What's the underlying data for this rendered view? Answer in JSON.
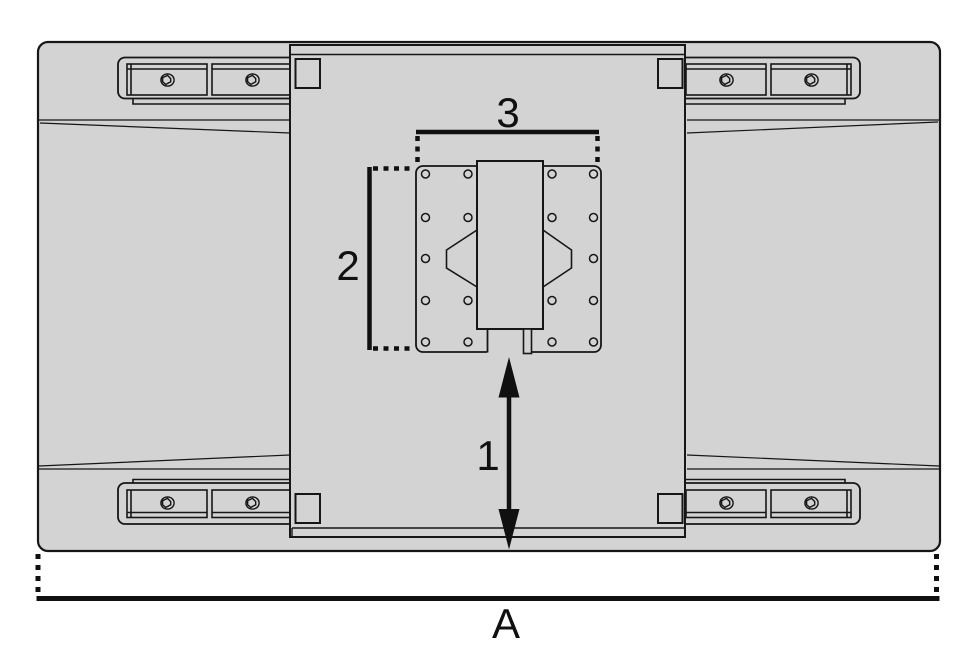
{
  "figure": {
    "labels": {
      "dim1": "1",
      "dim2": "2",
      "dim3": "3",
      "overall_width": "A"
    }
  },
  "colors": {
    "body_fill": "#d3d3d3",
    "line": "#161616",
    "dimension": "#101010",
    "background": "#ffffff"
  }
}
